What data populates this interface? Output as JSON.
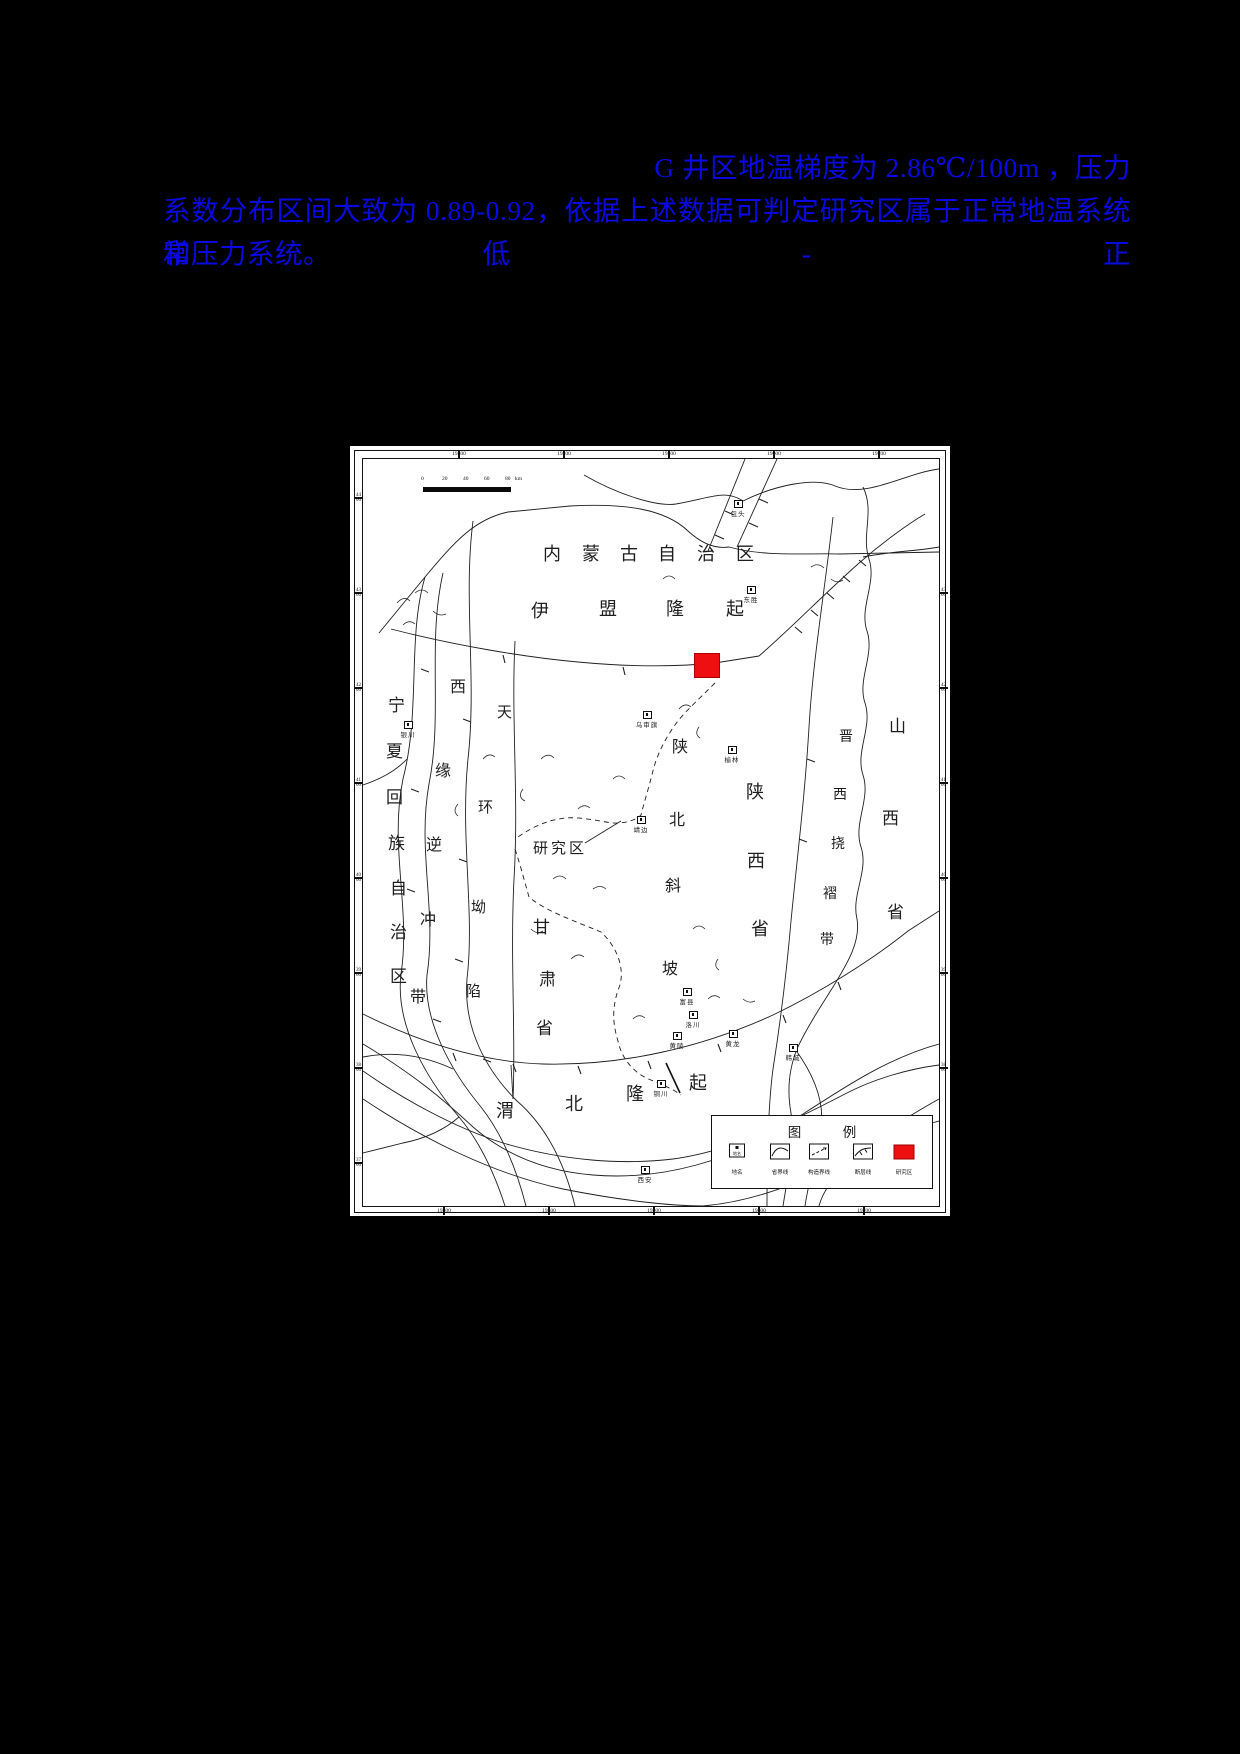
{
  "page": {
    "background": "#000000"
  },
  "paragraph": {
    "color": "#0a0ae0",
    "line1": "G 井区地温梯度为 2.86℃/100m ，压力",
    "line2": "系数分布区间大致为 0.89-0.92，依据上述数据可判定研究区属于正常地温系统和低-正",
    "line3": "常压力系统。"
  },
  "figure": {
    "bg": "#ffffff",
    "line_color": "#1f1f1f",
    "scale_bar": {
      "ticks": [
        "0",
        "20",
        "40",
        "60",
        "80"
      ],
      "unit": "km"
    },
    "axes": {
      "top": [
        {
          "v": "19300",
          "x": 96
        },
        {
          "v": "19400",
          "x": 201
        },
        {
          "v": "19500",
          "x": 306
        },
        {
          "v": "19600",
          "x": 411
        },
        {
          "v": "19700",
          "x": 516
        }
      ],
      "bottom": [
        {
          "v": "19300",
          "x": 81
        },
        {
          "v": "19400",
          "x": 186
        },
        {
          "v": "19500",
          "x": 291
        },
        {
          "v": "19600",
          "x": 396
        },
        {
          "v": "19700",
          "x": 501
        }
      ],
      "left": [
        {
          "a": "44",
          "b": "00",
          "y": 39
        },
        {
          "a": "43",
          "b": "00",
          "y": 134
        },
        {
          "a": "42",
          "b": "00",
          "y": 229
        },
        {
          "a": "41",
          "b": "00",
          "y": 324
        },
        {
          "a": "40",
          "b": "00",
          "y": 419
        },
        {
          "a": "39",
          "b": "00",
          "y": 514
        },
        {
          "a": "38",
          "b": "00",
          "y": 609
        },
        {
          "a": "37",
          "b": "00",
          "y": 704
        }
      ],
      "right": [
        {
          "a": "43",
          "b": "00",
          "y": 134
        },
        {
          "a": "42",
          "b": "00",
          "y": 229
        },
        {
          "a": "41",
          "b": "00",
          "y": 324
        },
        {
          "a": "40",
          "b": "00",
          "y": 419
        },
        {
          "a": "39",
          "b": "00",
          "y": 514
        },
        {
          "a": "38",
          "b": "00",
          "y": 609
        }
      ]
    },
    "region_labels": [
      {
        "id": "neimenggu-zizhiqu",
        "text": "内蒙古自治区",
        "fs": 18,
        "chars": [
          [
            180,
            86
          ],
          [
            219,
            86
          ],
          [
            257,
            86
          ],
          [
            295,
            86
          ],
          [
            334,
            86
          ],
          [
            373,
            86
          ]
        ]
      },
      {
        "id": "yimeng-longqi",
        "text": "伊盟隆起",
        "fs": 18,
        "chars": [
          [
            168,
            143
          ],
          [
            236,
            141
          ],
          [
            303,
            141
          ],
          [
            363,
            141
          ]
        ]
      },
      {
        "id": "weibei-longqi",
        "text": "渭北隆起",
        "fs": 18,
        "chars": [
          [
            133,
            643
          ],
          [
            202,
            636
          ],
          [
            263,
            626
          ],
          [
            326,
            615
          ]
        ]
      },
      {
        "id": "ningxia-huizu-zizhiqu",
        "text": "宁夏回族自治区",
        "fs": 17,
        "chars": [
          [
            25,
            238
          ],
          [
            23,
            284
          ],
          [
            23,
            330
          ],
          [
            25,
            376
          ],
          [
            27,
            421
          ],
          [
            27,
            465
          ],
          [
            27,
            509
          ]
        ]
      },
      {
        "id": "xiyuan-nichong-dai",
        "text": "西缘逆冲带",
        "fs": 16,
        "chars": [
          [
            87,
            221
          ],
          [
            72,
            305
          ],
          [
            63,
            379
          ],
          [
            57,
            454
          ],
          [
            47,
            531
          ]
        ]
      },
      {
        "id": "tianhuan-aoxian",
        "text": "天环坳陷",
        "fs": 15,
        "chars": [
          [
            134,
            247
          ],
          [
            115,
            342
          ],
          [
            108,
            442
          ],
          [
            103,
            526
          ]
        ]
      },
      {
        "id": "gansu-sheng",
        "text": "甘肃省",
        "fs": 17,
        "chars": [
          [
            170,
            460
          ],
          [
            176,
            512
          ],
          [
            173,
            561
          ]
        ]
      },
      {
        "id": "shanbei-xiepo",
        "text": "陕北斜坡",
        "fs": 16,
        "chars": [
          [
            309,
            281
          ],
          [
            306,
            354
          ],
          [
            302,
            420
          ],
          [
            299,
            503
          ]
        ]
      },
      {
        "id": "shaanxi-sheng",
        "text": "陕西省",
        "fs": 18,
        "chars": [
          [
            383,
            324
          ],
          [
            384,
            393
          ],
          [
            388,
            461
          ]
        ]
      },
      {
        "id": "jinxi-naozhe-dai",
        "text": "晋西挠褶带",
        "fs": 14,
        "chars": [
          [
            476,
            272
          ],
          [
            470,
            330
          ],
          [
            468,
            379
          ],
          [
            460,
            429
          ],
          [
            457,
            475
          ]
        ]
      },
      {
        "id": "shanxi-sheng",
        "text": "山西省",
        "fs": 17,
        "chars": [
          [
            526,
            259
          ],
          [
            519,
            351
          ],
          [
            524,
            445
          ]
        ]
      }
    ],
    "study_area": {
      "label": "研究区",
      "x": 331,
      "y": 194,
      "w": 24,
      "h": 23,
      "color": "#ee1010",
      "label_x": 170,
      "label_y": 378,
      "label_fs": 15
    },
    "towns": [
      {
        "name": "包头",
        "x": 375,
        "y": 44
      },
      {
        "name": "东胜",
        "x": 388,
        "y": 130
      },
      {
        "name": "乌审旗",
        "x": 284,
        "y": 255
      },
      {
        "name": "榆林",
        "x": 369,
        "y": 290
      },
      {
        "name": "靖边",
        "x": 278,
        "y": 360
      },
      {
        "name": "银川",
        "x": 45,
        "y": 265
      },
      {
        "name": "富县",
        "x": 324,
        "y": 532
      },
      {
        "name": "洛川",
        "x": 330,
        "y": 555
      },
      {
        "name": "黄陵",
        "x": 314,
        "y": 576
      },
      {
        "name": "黄龙",
        "x": 370,
        "y": 574
      },
      {
        "name": "韩城",
        "x": 430,
        "y": 588
      },
      {
        "name": "铜川",
        "x": 298,
        "y": 624
      },
      {
        "name": "西安",
        "x": 282,
        "y": 710
      }
    ],
    "legend": {
      "title": "图　例",
      "items": [
        {
          "label": "地名",
          "type": "town"
        },
        {
          "label": "省界线",
          "type": "province"
        },
        {
          "label": "构造界线",
          "type": "tectonic"
        },
        {
          "label": "断层线",
          "type": "fault"
        },
        {
          "label": "研究区",
          "type": "study"
        }
      ]
    }
  }
}
